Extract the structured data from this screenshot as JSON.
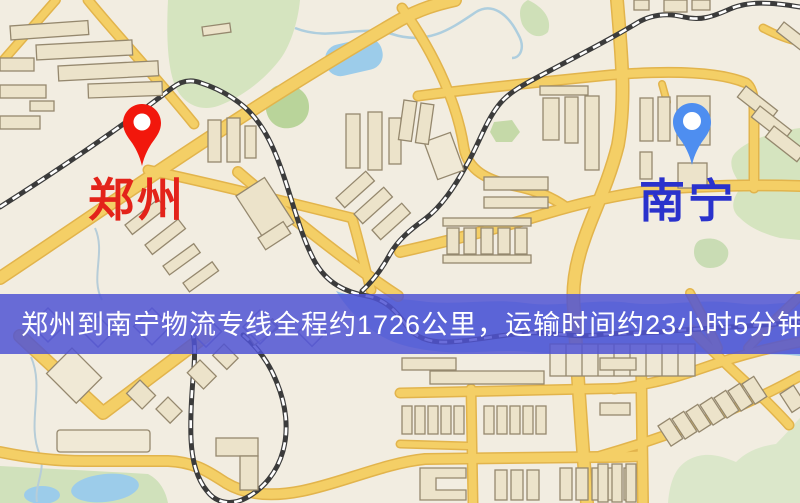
{
  "banner": {
    "text": "郑州到南宁物流专线全程约1726公里，运输时间约23小时5分钟.",
    "background_color": "#5054d4",
    "text_color": "#ffffff"
  },
  "markers": [
    {
      "name": "origin",
      "label": "郑州",
      "pin_color": "#f2170c",
      "label_color": "#e3231a"
    },
    {
      "name": "destination",
      "label": "南宁",
      "pin_color": "#4e8ef0",
      "label_color": "#2a32cc"
    }
  ],
  "route_info": {
    "origin": "郑州",
    "destination": "南宁",
    "distance_text": "约1726公里",
    "duration_text": "约23小时5分钟"
  },
  "map_colors": {
    "background": "#f2ede1",
    "road_fill": "#f4cf66",
    "road_casing": "#e2b44c",
    "railway_dark": "#3b3b3b",
    "railway_light": "#ffffff",
    "water": "#9cc8e8",
    "park_green": "#d5e4bf",
    "building_fill": "#ece3ca",
    "building_stroke": "#95886e"
  }
}
